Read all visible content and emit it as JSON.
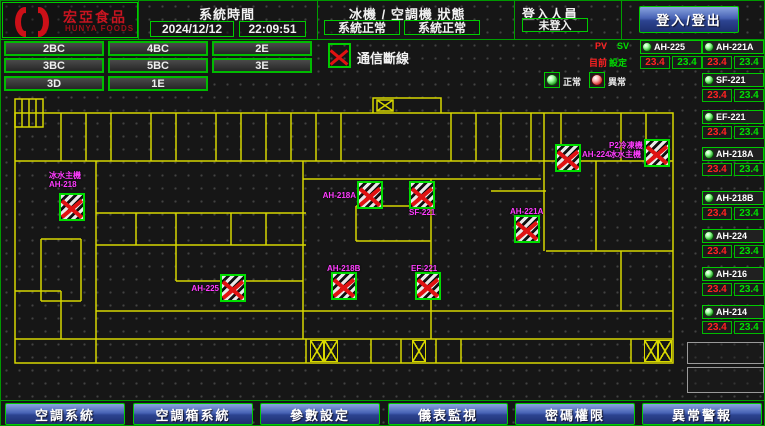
{
  "header": {
    "logo_title": "宏亞食品",
    "logo_subtitle": "HUNYA FOODS",
    "system_time_label": "系統時間",
    "date": "2024/12/12",
    "time": "22:09:51",
    "status_label": "冰機 / 空調機 狀態",
    "chiller_status": "系統正常",
    "ahu_status": "系統正常",
    "login_label": "登入人員",
    "login_status": "未登入",
    "login_button": "登入/登出"
  },
  "floor_buttons": [
    {
      "label": "2BC",
      "x": 3,
      "y": 40
    },
    {
      "label": "4BC",
      "x": 107,
      "y": 40
    },
    {
      "label": "2E",
      "x": 211,
      "y": 40
    },
    {
      "label": "3BC",
      "x": 3,
      "y": 57
    },
    {
      "label": "5BC",
      "x": 107,
      "y": 57
    },
    {
      "label": "3E",
      "x": 211,
      "y": 57
    },
    {
      "label": "3D",
      "x": 3,
      "y": 75
    },
    {
      "label": "1E",
      "x": 107,
      "y": 75
    }
  ],
  "legend": {
    "comm_loss": "通信斷線",
    "normal": "正常",
    "abnormal": "異常",
    "pv": "PV",
    "sv": "SV",
    "pv_row": "目前",
    "sv_row": "設定"
  },
  "panel": {
    "units": [
      {
        "name": "AH-225",
        "pv": "23.4",
        "sv": "23.4",
        "x": 639,
        "y": 39
      },
      {
        "name": "AH-221A",
        "pv": "23.4",
        "sv": "23.4",
        "x": 701,
        "y": 39
      },
      {
        "name": "SF-221",
        "pv": "23.4",
        "sv": "23.4",
        "x": 701,
        "y": 72
      },
      {
        "name": "EF-221",
        "pv": "23.4",
        "sv": "23.4",
        "x": 701,
        "y": 109
      },
      {
        "name": "AH-218A",
        "pv": "23.4",
        "sv": "23.4",
        "x": 701,
        "y": 146
      },
      {
        "name": "AH-218B",
        "pv": "23.4",
        "sv": "23.4",
        "x": 701,
        "y": 190
      },
      {
        "name": "AH-224",
        "pv": "23.4",
        "sv": "23.4",
        "x": 701,
        "y": 228
      },
      {
        "name": "AH-216",
        "pv": "23.4",
        "sv": "23.4",
        "x": 701,
        "y": 266
      },
      {
        "name": "AH-214",
        "pv": "23.4",
        "sv": "23.4",
        "x": 701,
        "y": 304
      }
    ]
  },
  "floorplan": {
    "markers": [
      {
        "x": 58,
        "y": 192
      },
      {
        "label": "AH-218A",
        "pos": "left",
        "x": 356,
        "y": 180
      },
      {
        "label": "SF-221",
        "pos": "below",
        "x": 408,
        "y": 180
      },
      {
        "label": "AH-221A",
        "pos": "above",
        "x": 513,
        "y": 214
      },
      {
        "label": "AH-224",
        "pos": "right",
        "x": 554,
        "y": 143
      },
      {
        "x": 643,
        "y": 138
      },
      {
        "label": "AH-225",
        "pos": "left",
        "x": 219,
        "y": 273
      },
      {
        "label": "AH-218B",
        "pos": "above",
        "x": 330,
        "y": 271
      },
      {
        "label": "EF-221",
        "pos": "above",
        "x": 414,
        "y": 271
      }
    ],
    "texts": [
      {
        "line1": "冰水主機",
        "line2": "AH-218",
        "x": 48,
        "y": 170
      },
      {
        "line1": "P2冷凍機",
        "line2": "冰水主機",
        "x": 608,
        "y": 140
      }
    ],
    "rooms": [
      {
        "t": "工具室",
        "x": 176,
        "y": 118
      },
      {
        "t": "合格品倉庫",
        "x": 328,
        "y": 128
      },
      {
        "t": "配料室",
        "x": 233,
        "y": 114,
        "v": 1
      },
      {
        "t": "原料室",
        "x": 258,
        "y": 114,
        "v": 1
      },
      {
        "t": "AH-B3",
        "x": 518,
        "y": 128
      },
      {
        "t": "維修保養室",
        "x": 495,
        "y": 155
      },
      {
        "t": "空調機房",
        "x": 548,
        "y": 167
      },
      {
        "t": "冰水機房",
        "x": 634,
        "y": 165
      },
      {
        "t": "包裝室",
        "x": 118,
        "y": 225
      },
      {
        "t": "資材工具倉庫",
        "x": 182,
        "y": 225
      },
      {
        "t": "2號室",
        "x": 362,
        "y": 217
      },
      {
        "t": "更衣室",
        "x": 352,
        "y": 260
      },
      {
        "t": "更衣室",
        "x": 657,
        "y": 256,
        "v": 1
      },
      {
        "t": "女廁",
        "x": 339,
        "y": 344
      },
      {
        "t": "男廁",
        "x": 386,
        "y": 344
      },
      {
        "t": "冰機房",
        "x": 49,
        "y": 246,
        "v": 1
      },
      {
        "t": "梯",
        "x": 664,
        "y": 324
      }
    ],
    "stairs": [
      {
        "x": 309,
        "y": 339
      },
      {
        "x": 323,
        "y": 339
      },
      {
        "x": 411,
        "y": 339
      },
      {
        "x": 643,
        "y": 339
      },
      {
        "x": 657,
        "y": 339
      }
    ]
  },
  "nav": [
    {
      "label": "空調系統",
      "x": 4
    },
    {
      "label": "空調箱系統",
      "x": 132
    },
    {
      "label": "參數設定",
      "x": 259
    },
    {
      "label": "儀表監視",
      "x": 387
    },
    {
      "label": "密碼權限",
      "x": 514
    },
    {
      "label": "異常警報",
      "x": 641
    }
  ]
}
